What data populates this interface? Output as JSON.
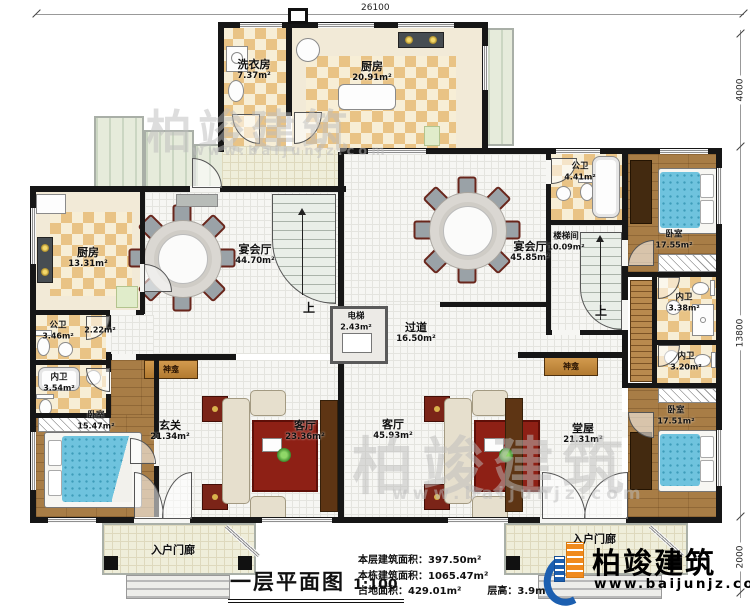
{
  "plan": {
    "title": "一层平面图",
    "scale": "1:100"
  },
  "stats": {
    "l1": "本层建筑面积：",
    "v1": "397.50m²",
    "l2": "本栋建筑面积：",
    "v2": "1065.47m²",
    "l3": "占地面积：",
    "v3": "429.01m²",
    "l4": "层高：",
    "v4": "3.9m"
  },
  "dims": {
    "top": "26100",
    "right_top": "4000",
    "right_mid": "13800",
    "right_bottom": "2000"
  },
  "rooms": {
    "laundry": {
      "name": "洗衣房",
      "area": "7.37m²"
    },
    "kitchen_top": {
      "name": "厨房",
      "area": "20.91m²"
    },
    "kitchen_left": {
      "name": "厨房",
      "area": "13.31m²"
    },
    "banquet_left": {
      "name": "宴会厅",
      "area": "44.70m²"
    },
    "banquet_right": {
      "name": "宴会厅",
      "area": "45.85m²"
    },
    "pub_bath_right": {
      "name": "公卫",
      "area": "4.41m²"
    },
    "stairwell": {
      "name": "楼梯间",
      "area": "10.09m²"
    },
    "bedroom_tr": {
      "name": "卧室",
      "area": "17.55m²"
    },
    "bath_tr": {
      "name": "内卫",
      "area": "3.38m²"
    },
    "bath_br": {
      "name": "内卫",
      "area": "3.20m²"
    },
    "bedroom_br": {
      "name": "卧室",
      "area": "17.51m²"
    },
    "corridor": {
      "name": "过道",
      "area": "16.50m²"
    },
    "elevator": {
      "name": "电梯",
      "area": "2.43m²"
    },
    "pub_bath_left": {
      "name": "公卫",
      "area": "3.46m²"
    },
    "hall_small": {
      "area": "2.22m²"
    },
    "bath_left": {
      "name": "内卫",
      "area": "3.54m²"
    },
    "bedroom_bl": {
      "name": "卧室",
      "area": "15.47m²"
    },
    "foyer": {
      "name": "玄关",
      "area": "21.34m²"
    },
    "living_left": {
      "name": "客厅",
      "area": "23.36m²"
    },
    "living_right": {
      "name": "客厅",
      "area": "45.93m²"
    },
    "main_hall": {
      "name": "堂屋",
      "area": "21.31m²"
    },
    "porch_left": {
      "name": "入户门廊"
    },
    "porch_right": {
      "name": "入户门廊"
    },
    "altar_left": {
      "name": "神龛"
    },
    "altar_right": {
      "name": "神龛"
    }
  },
  "labels": {
    "up": "上"
  },
  "watermark": {
    "name": "柏竣建筑",
    "url": "www.baijunjz.com"
  },
  "logo": {
    "name": "柏竣建筑",
    "url": "www.baijunjz.com"
  },
  "colors": {
    "wall": "#161616",
    "checker": "#e9c385",
    "wood": "#a87d46",
    "bed_blue": "#6fc3de",
    "rug_red": "#8e2015",
    "logo_blue": "#1c5fb0",
    "logo_orange": "#f08a1d"
  }
}
